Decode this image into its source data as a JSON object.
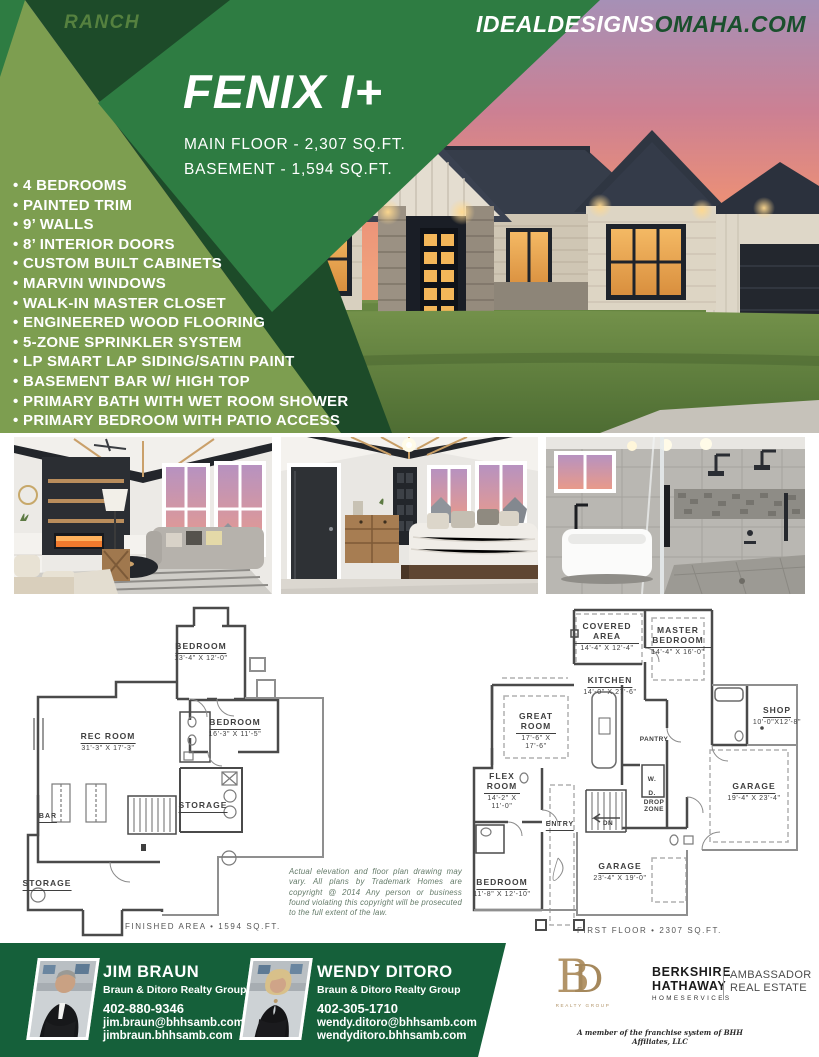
{
  "header": {
    "category": "RANCH",
    "site_white": "IDEALDESIGNS",
    "site_green": "OMAHA.COM",
    "plan_name": "FENIX I+",
    "main_floor_line": "MAIN FLOOR - 2,307 SQ.FT.",
    "basement_line": "BASEMENT - 1,594 SQ.FT."
  },
  "features": [
    "4 BEDROOMS",
    "PAINTED TRIM",
    "9’ WALLS",
    "8’ INTERIOR DOORS",
    "CUSTOM BUILT CABINETS",
    "MARVIN WINDOWS",
    "WALK-IN MASTER CLOSET",
    "ENGINEERED WOOD FLOORING",
    "5-ZONE SPRINKLER SYSTEM",
    "LP SMART LAP SIDING/SATIN PAINT",
    "BASEMENT BAR W/ HIGH TOP",
    "PRIMARY BATH WITH WET ROOM SHOWER",
    "PRIMARY BEDROOM WITH PATIO ACCESS"
  ],
  "basement_plan": {
    "rooms": [
      {
        "name": "BEDROOM",
        "dims": "13'-4\" X 12'-0\""
      },
      {
        "name": "BEDROOM",
        "dims": "16'-3\" X 11'-5\""
      },
      {
        "name": "REC ROOM",
        "dims": "31'-3\" X 17'-3\""
      },
      {
        "name": "BAR",
        "dims": ""
      },
      {
        "name": "STORAGE",
        "dims": ""
      },
      {
        "name": "STORAGE",
        "dims": ""
      }
    ],
    "area_label": "FINISHED AREA • 1594 SQ.FT."
  },
  "main_plan": {
    "rooms": [
      {
        "name": "COVERED AREA",
        "dims": "14'-4\" X 12'-4\""
      },
      {
        "name": "MASTER BEDROOM",
        "dims": "14'-4\" X 16'-0\""
      },
      {
        "name": "KITCHEN",
        "dims": "14'-0\" X 27'-6\""
      },
      {
        "name": "GREAT ROOM",
        "dims": "17'-6\" X 17'-6\""
      },
      {
        "name": "SHOP",
        "dims": "10'-0\"X12'-8\""
      },
      {
        "name": "PANTRY",
        "dims": ""
      },
      {
        "name": "FLEX ROOM",
        "dims": "14'-2\" X 11'-0\""
      },
      {
        "name": "ENTRY",
        "dims": ""
      },
      {
        "name": "W.",
        "dims": ""
      },
      {
        "name": "D.",
        "dims": ""
      },
      {
        "name": "DROP ZONE",
        "dims": ""
      },
      {
        "name": "DN",
        "dims": ""
      },
      {
        "name": "GARAGE",
        "dims": "19'-4\" X 23'-4\""
      },
      {
        "name": "GARAGE",
        "dims": "23'-4\" X 19'-0\""
      },
      {
        "name": "BEDROOM",
        "dims": "11'-8\" X 12'-10\""
      }
    ],
    "area_label": "FIRST FLOOR • 2307 SQ.FT."
  },
  "disclaimer": "Actual elevation and floor plan drawing may vary. All plans by Trademark Homes are copyright @ 2014 Any person or business found violating this copyright will be prosecuted to the full extent of the law.",
  "footer": {
    "agents": [
      {
        "name": "JIM BRAUN",
        "group": "Braun & Ditoro Realty Group",
        "phone": "402-880-9346",
        "email": "jim.braun@bhhsamb.com",
        "website": "jimbraun.bhhsamb.com"
      },
      {
        "name": "WENDY DITORO",
        "group": "Braun & Ditoro Realty Group",
        "phone": "402-305-1710",
        "email": "wendy.ditoro@bhhsamb.com",
        "website": "wendyditoro.bhhsamb.com"
      }
    ],
    "bd_logo": {
      "letter_b": "B",
      "letter_d": "D",
      "caption": "REALTY GROUP"
    },
    "brokerage": {
      "name1": "BERKSHIRE",
      "name2": "HATHAWAY",
      "name3": "HOMESERVICES",
      "affiliate1": "AMBASSADOR",
      "affiliate2": "REAL ESTATE"
    },
    "franchise_note": "A member of the franchise system of BHH Affiliates, LLC"
  },
  "colors": {
    "olive": "#7d9e50",
    "band_green": "#2e7c42",
    "dark_green": "#1d4b29",
    "footer_green": "#15603a",
    "site_green": "#1a4f2d",
    "gold": "#b29468"
  }
}
